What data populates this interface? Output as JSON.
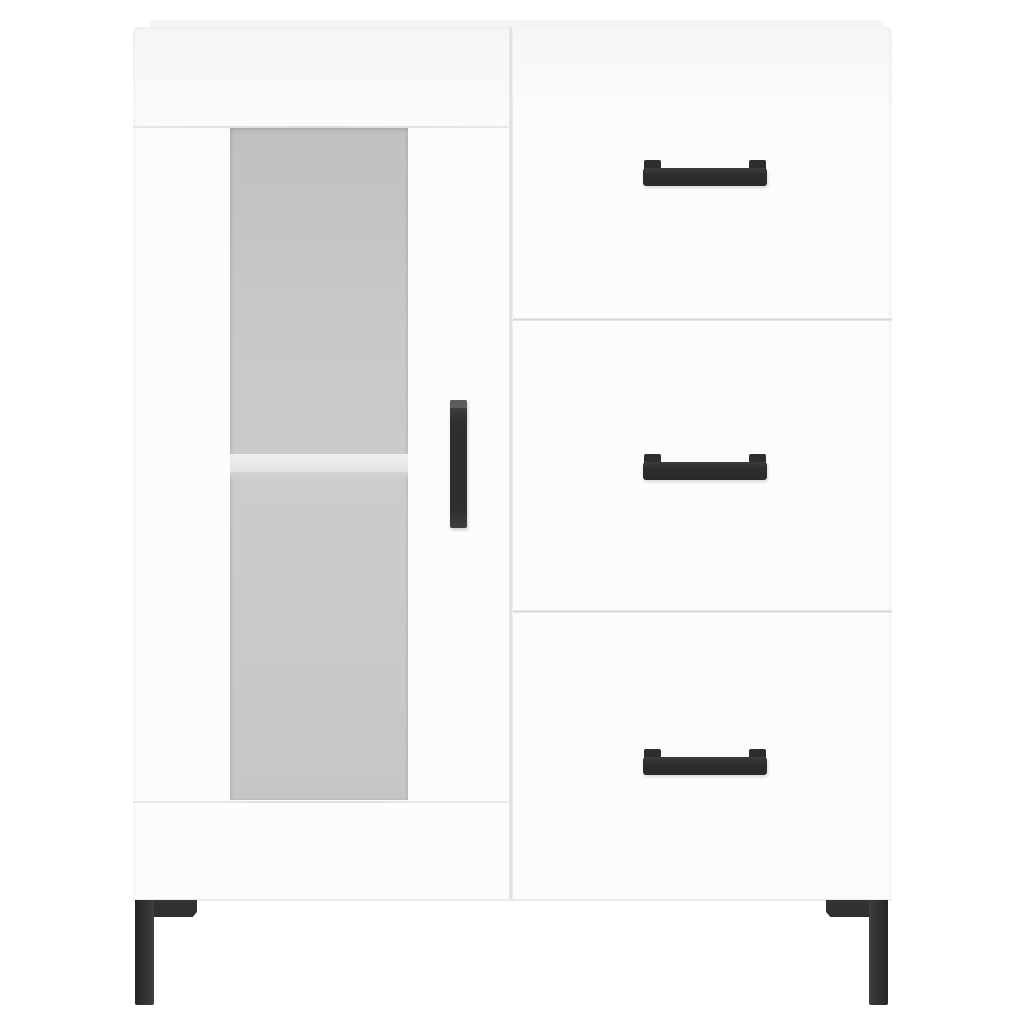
{
  "scene": {
    "type": "product-photo",
    "object": "sideboard-cabinet",
    "description": "White highboard sideboard with one glass-panel door on the left, three drawers on the right, black bar handles and black metal legs, on a plain white background"
  },
  "colors": {
    "background": "#ffffff",
    "cabinet-white": "#fcfcfc",
    "cabinet-shade": "#f6f6f6",
    "top-sliver": "#f4f4f4",
    "seam": "#dcdcdc",
    "glass-top": "#bfc1c0",
    "glass-mid": "#c7c9c8",
    "glass-bottom": "#c5c7c6",
    "shelf": "#e8eae9",
    "shelf-shadow": "#d3d5d4",
    "hardware": "#2e2e2e",
    "hardware-highlight": "#565656"
  },
  "structure": {
    "door": {
      "label": "glass door with vertical black handle",
      "glass_panel": "frosted glass",
      "shelf_count": 1
    },
    "drawers": {
      "count": 3,
      "handle_style": "black horizontal bar handle with raised end posts",
      "items": [
        {
          "label": "top drawer"
        },
        {
          "label": "middle drawer"
        },
        {
          "label": "bottom drawer"
        }
      ]
    },
    "legs": {
      "count": 2,
      "label": "black metal corner legs"
    }
  }
}
